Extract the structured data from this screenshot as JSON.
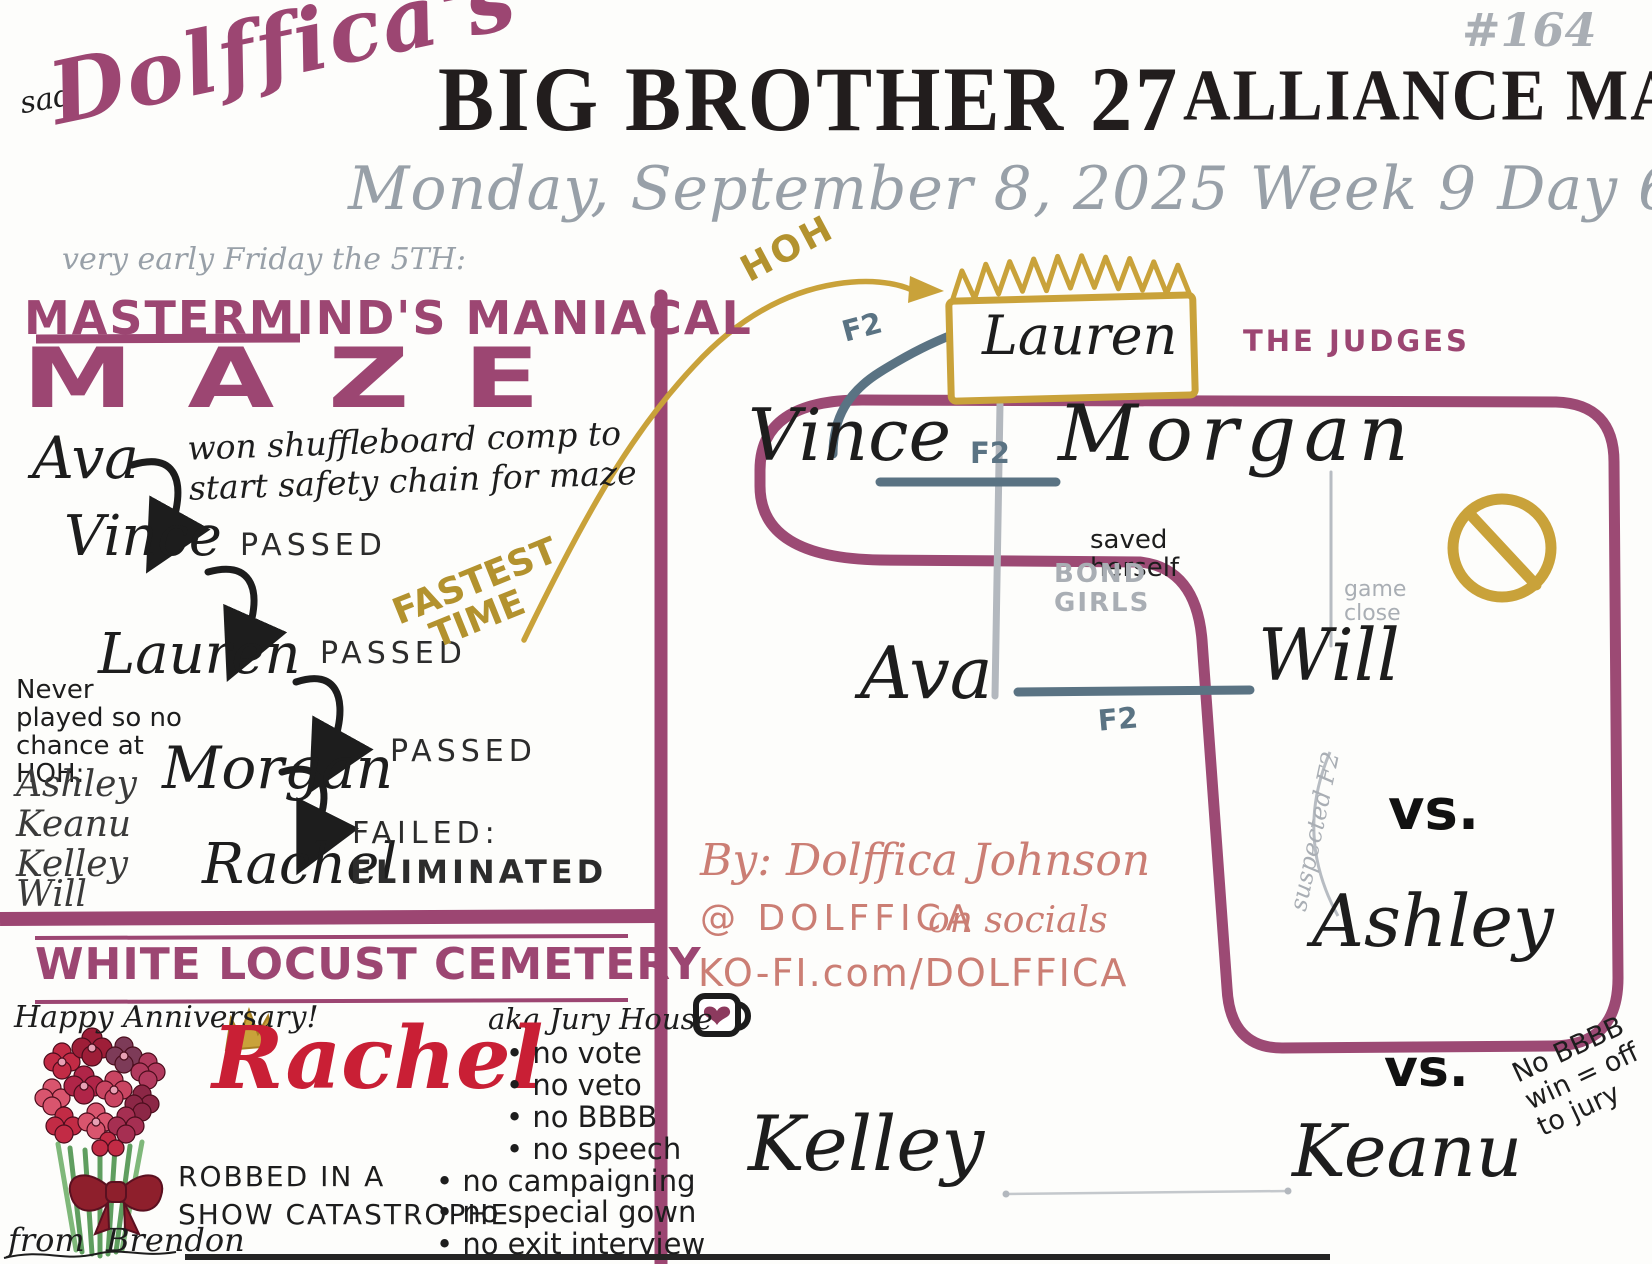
{
  "colors": {
    "purple_marker": "#9c4672",
    "gold": "#c9a23a",
    "slate_blue": "#5a7383",
    "soft_gray": "#a9aeb4",
    "date_gray": "#98a0a8",
    "red": "#c91f35",
    "salmon": "#cb7e74",
    "ink": "#1d1d1d"
  },
  "header": {
    "mood_note": "sad",
    "artist_name": "Dolffica's",
    "title": "BIG BROTHER 27",
    "title2": "ALLIANCE MAP",
    "issue": "#164",
    "date_line": "Monday, September 8, 2025   Week 9   Day 63",
    "time_note": "very early Friday the 5TH:"
  },
  "maze": {
    "title_line1": "MASTERMIND'S MANIACAL",
    "title_line2": "MAZE",
    "intro_note": "won shuffleboard comp to start safety chain for maze",
    "chain": [
      {
        "name": "Ava",
        "result": ""
      },
      {
        "name": "Vince",
        "result": "PASSED"
      },
      {
        "name": "Lauren",
        "result": "PASSED"
      },
      {
        "name": "Morgan",
        "result": "PASSED"
      },
      {
        "name": "Rachel",
        "result": "FAILED:"
      }
    ],
    "eliminated_label": "ELIMINATED",
    "fastest_line1": "FASTEST",
    "fastest_line2": "TIME",
    "sidebar_note": "Never played so no chance at HOH:",
    "sidebar_names": [
      "Ashley",
      "Keanu",
      "Kelley",
      "Will"
    ]
  },
  "map": {
    "hoh_label": "HOH",
    "hoh_holder": "Lauren",
    "judges_label": "THE JUDGES",
    "f2_label": "F2",
    "bond_girls_line1": "BOND",
    "bond_girls_line2": "GIRLS",
    "vince": "Vince",
    "morgan": "Morgan",
    "ava": "Ava",
    "will": "Will",
    "ashley": "Ashley",
    "kelley": "Kelley",
    "keanu": "Keanu",
    "saved_line1": "saved",
    "saved_line2": "herself",
    "game_close_line1": "game",
    "game_close_line2": "close",
    "suspected_f2": "suspected F2",
    "versus1": "vs.",
    "versus2": "vs.",
    "jury_line1": "No BBBB",
    "jury_line2": "win = off",
    "jury_line3": "to jury"
  },
  "credits": {
    "by_line": "By: Dolffica Johnson",
    "handle": "@ DOLFFICA",
    "handle_suffix": "on socials",
    "kofi": "KO-FI.com/DOLFFICA"
  },
  "cemetery": {
    "heading": "WHITE LOCUST CEMETERY",
    "anniversary": "Happy Anniversary!",
    "aka_label": "aka Jury House",
    "resident": "Rachel",
    "rules": [
      "no vote",
      "no veto",
      "no BBBB",
      "no speech",
      "no campaigning",
      "no special gown",
      "no exit interview"
    ],
    "robbed_line1": "ROBBED IN A",
    "robbed_line2": "SHOW CATASTROPHE",
    "from_label": "from",
    "from_name": "Brendon"
  }
}
